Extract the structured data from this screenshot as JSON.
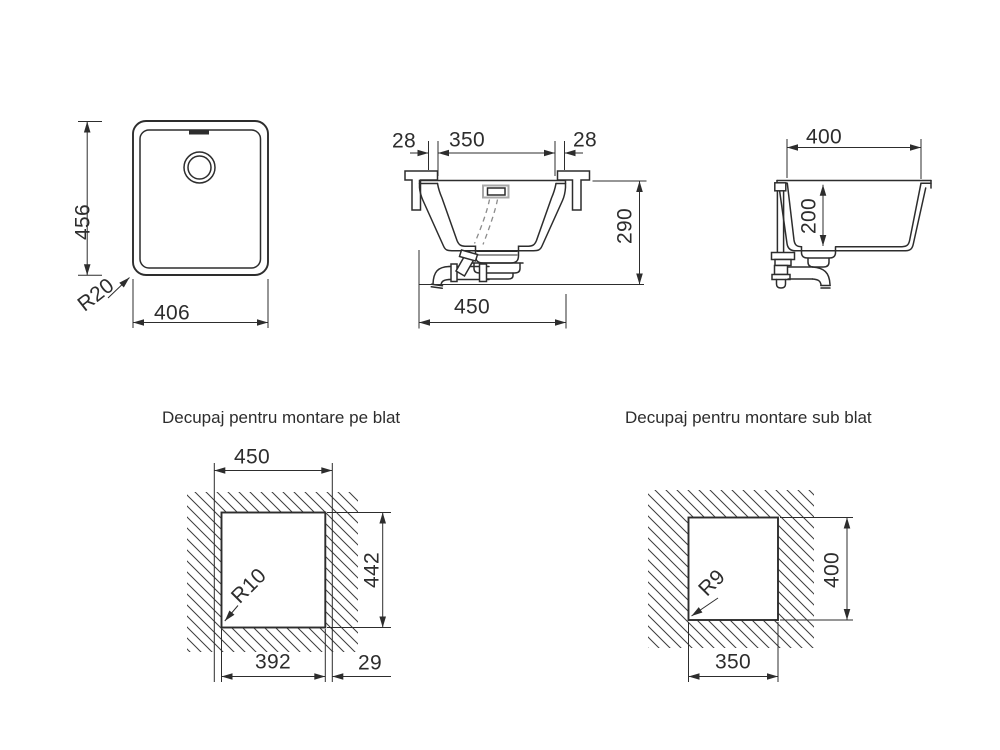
{
  "titles": {
    "topmount": "Decupaj pentru montare pe blat",
    "undermount": "Decupaj pentru montare sub blat"
  },
  "plan_view": {
    "height": "456",
    "width": "406",
    "corner_radius": "R20"
  },
  "front_section": {
    "left_overhang": "28",
    "cutout_width": "350",
    "right_overhang": "28",
    "depth": "290",
    "overall_width": "450"
  },
  "side_section": {
    "width": "400",
    "bowl_depth": "200"
  },
  "topmount_cutout": {
    "overall_width": "450",
    "height": "442",
    "cutout_width": "392",
    "edge_offset": "29",
    "corner_radius": "R10"
  },
  "undermount_cutout": {
    "cutout_width": "350",
    "height": "400",
    "corner_radius": "R9"
  },
  "colors": {
    "line": "#2d2d2d",
    "hidden_line": "#8c8c8c",
    "background": "#ffffff"
  }
}
